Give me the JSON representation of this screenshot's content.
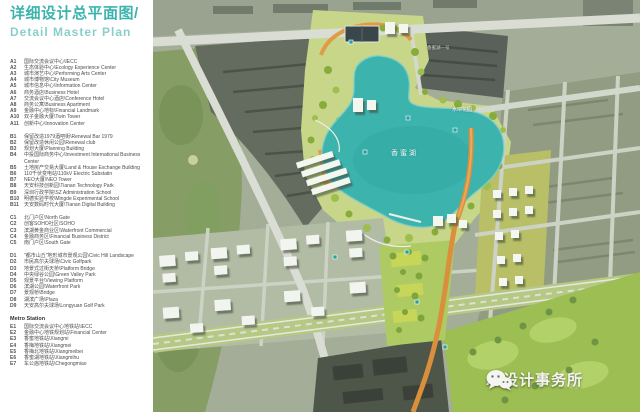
{
  "header": {
    "title_zh": "详细设计总平面图/",
    "title_en": "Detail Master Plan"
  },
  "legend": {
    "groups": [
      {
        "name": "A",
        "items": [
          [
            "A1",
            "国际交流会议中心\\IECC"
          ],
          [
            "A2",
            "生态体验中心\\Ecology Experience Center"
          ],
          [
            "A3",
            "城市演艺中心\\Performing Arts Center"
          ],
          [
            "A4",
            "城市博物馆\\City Museum"
          ],
          [
            "A5",
            "城市信息中心\\Information Center"
          ],
          [
            "A6",
            "商务酒店\\Business Hotel"
          ],
          [
            "A7",
            "交流会议中心酒店\\Conference Hotel"
          ],
          [
            "A8",
            "商务公寓\\Business Apartment"
          ],
          [
            "A9",
            "金融中心地标\\Financial Landmark"
          ],
          [
            "A10",
            "双子金融大厦\\Twin Tower"
          ],
          [
            "A11",
            "创新中心\\Innovation Center"
          ]
        ]
      },
      {
        "name": "B",
        "items": [
          [
            "B1",
            "保留改造1979酒吧街\\Renewal Bar 1979"
          ],
          [
            "B2",
            "保留改造休闲公园\\Renewal club"
          ],
          [
            "B3",
            "规划大厦\\Planning Building"
          ],
          [
            "B4",
            "中投国际商务中心\\Investment International Business Center"
          ],
          [
            "B5",
            "土地房产交易大厦\\Land & House Exchange Building"
          ],
          [
            "B6",
            "110千伏变电站\\110kV Electric Substatin"
          ],
          [
            "B7",
            "NEO大厦\\NEO Tower"
          ],
          [
            "B8",
            "天安科技创新园\\Tianan Technology Park"
          ],
          [
            "B9",
            "深圳行政学院\\SZ Administration School"
          ],
          [
            "B10",
            "明德实验学校\\Mingde Experimental School"
          ],
          [
            "B11",
            "天安数码时代大厦\\Tianan Digital Building"
          ]
        ]
      },
      {
        "name": "C",
        "items": [
          [
            "C1",
            "北门户区\\North Gate"
          ],
          [
            "C2",
            "创客SOHO社区\\SOHO"
          ],
          [
            "C3",
            "滨湖黄金商业区\\Waterfront Commercial"
          ],
          [
            "C4",
            "金融商务区\\Financial Business District"
          ],
          [
            "C5",
            "南门户区\\South Gate"
          ]
        ]
      },
      {
        "name": "D",
        "items": [
          [
            "D1",
            "\"都市山丘\"地形城市景观公园\\Civic Hill Landscape"
          ],
          [
            "D2",
            "市民高尔夫球场\\Civic Golfpark"
          ],
          [
            "D3",
            "地景式过街天桥\\Platform Bridge"
          ],
          [
            "D4",
            "中央绿谷公园\\Green Valley Park"
          ],
          [
            "D5",
            "观景平台\\Viewing Platform"
          ],
          [
            "D6",
            "滨湖公园\\Waterfront Park"
          ],
          [
            "D7",
            "景观桥\\Bridge"
          ],
          [
            "D8",
            "湖滨广场\\Plaza"
          ],
          [
            "D9",
            "天安高尔夫球场\\Longyuan Golf Park"
          ]
        ]
      }
    ],
    "metro": {
      "header": "Metro Station",
      "items": [
        [
          "E1",
          "国际交流会议中心地铁站\\IECC"
        ],
        [
          "E2",
          "金融中心地铁规划站\\Financial Center"
        ],
        [
          "E3",
          "香蜜地铁站\\Xiangmi"
        ],
        [
          "E4",
          "香梅地铁站\\Xiangmei"
        ],
        [
          "E5",
          "香梅北地铁站\\Xiangmeibei"
        ],
        [
          "E6",
          "香蜜湖地铁站\\Xiangmihu"
        ],
        [
          "E7",
          "车公庙地铁站\\Chegongmiao"
        ]
      ]
    }
  },
  "map": {
    "labels": {
      "lake": "香蜜湖",
      "garden": "水帘花园",
      "estate": "香蜜湖一号"
    },
    "watermark": "AI设计事务所"
  },
  "colors": {
    "title_teal": "#3cb4ad",
    "subtitle_teal": "#8aceca",
    "lake": "#3db3ad",
    "path_orange": "#d98f3c",
    "park_green": "#c8d689",
    "golf_green": "#9cbe53"
  }
}
